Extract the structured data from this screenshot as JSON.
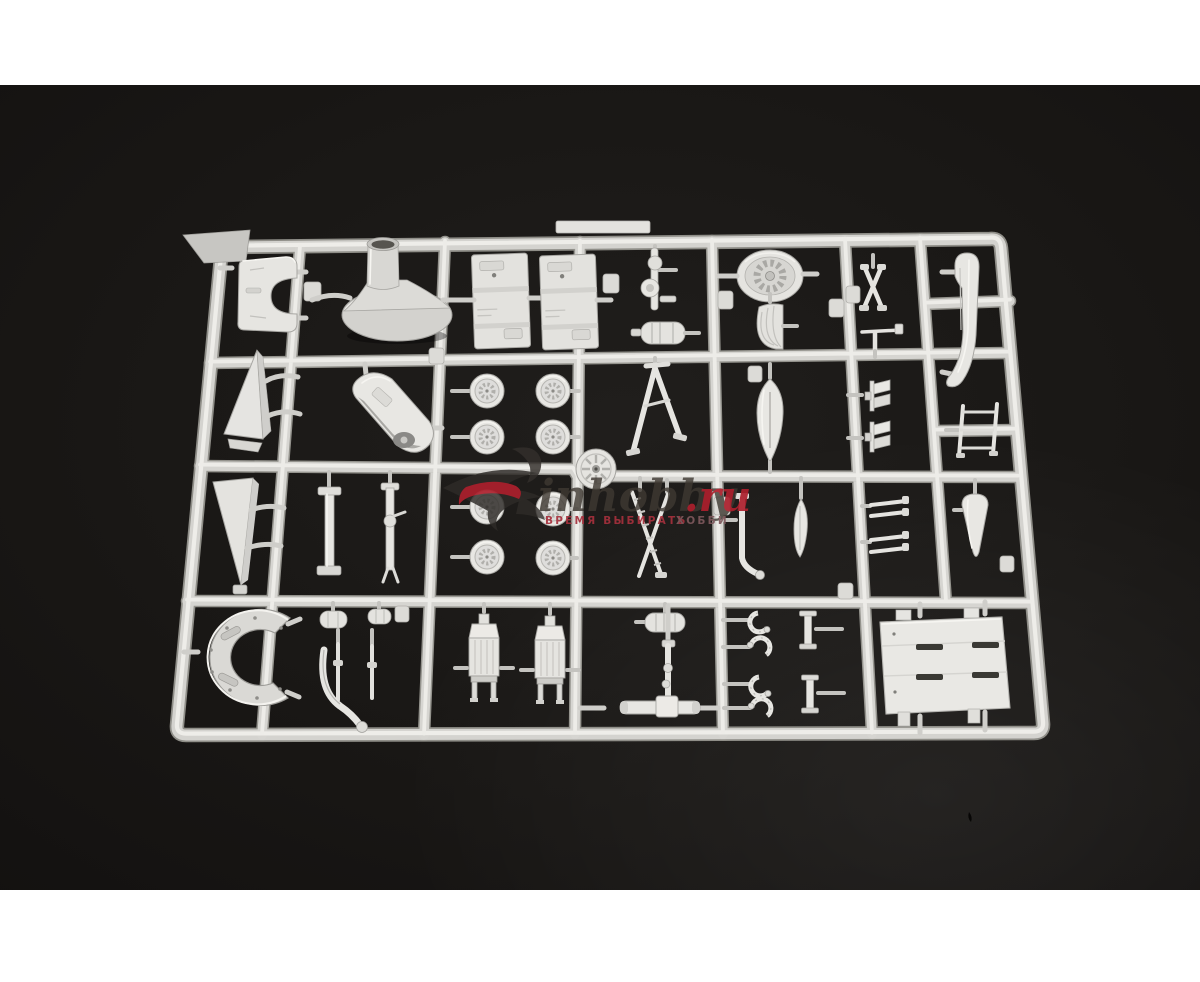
{
  "image": {
    "description": "Product photo of a light-grey injection-moulded plastic model kit sprue (parts frame) lying on a black background, letterboxed with white bars top and bottom",
    "letterbox_color": "#ffffff",
    "background_color": "#18161412",
    "photo_background": "#191715",
    "sprue_color": "#d6d5d1",
    "part_color": "#e7e6e2",
    "highlight_color": "#eeede9",
    "accent_red": "#ad202d"
  },
  "watermark": {
    "logo_icon": "swoosh-bird-logo",
    "site_name": "inhobby",
    "domain_suffix": ".ru",
    "tagline_left": "ВРЕМЯ ВЫБИРАТЬ",
    "tagline_right": "ХОББИ",
    "tagline_color": "#a5303c",
    "tagline_right_color": "#7e585c"
  },
  "sprue_contents": {
    "grid": {
      "rows": 4,
      "columns": 6
    },
    "parts_inventory": [
      {
        "part": "c-shaped-cowl-panel",
        "count": 2
      },
      {
        "part": "engine-cowling-cone",
        "count": 1
      },
      {
        "part": "interior-side-panel",
        "count": 2
      },
      {
        "part": "radial-engine-front-plate",
        "count": 1
      },
      {
        "part": "supercharger-housing",
        "count": 1
      },
      {
        "part": "wheel",
        "count": 8
      },
      {
        "part": "spoked-hub-disc",
        "count": 1
      },
      {
        "part": "windscreen-wedge",
        "count": 2
      },
      {
        "part": "fuselage-spine-shell",
        "count": 1
      },
      {
        "part": "landing-gear-strut",
        "count": 6
      },
      {
        "part": "propeller-blade",
        "count": 1
      },
      {
        "part": "teardrop-fairing",
        "count": 2
      },
      {
        "part": "tail-cone",
        "count": 1
      },
      {
        "part": "bomb-fin-set",
        "count": 2
      },
      {
        "part": "engine-block",
        "count": 2
      },
      {
        "part": "exhaust-pipe",
        "count": 1
      },
      {
        "part": "tailwheel-yoke-assembly",
        "count": 1
      },
      {
        "part": "clevis-fork",
        "count": 4
      },
      {
        "part": "flanged-post",
        "count": 2
      },
      {
        "part": "slotted-bulkhead-plate",
        "count": 1
      }
    ]
  }
}
